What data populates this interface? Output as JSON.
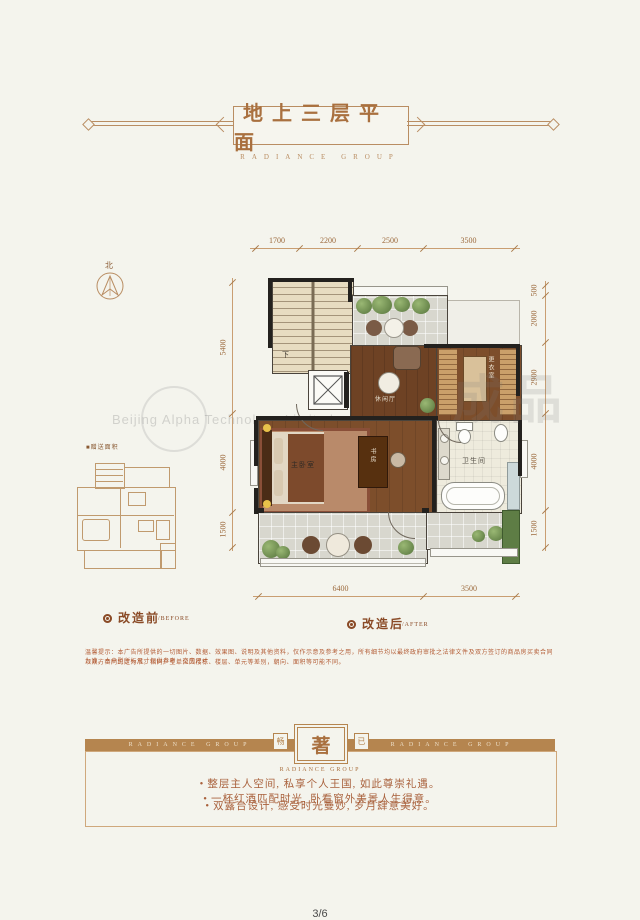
{
  "header": {
    "title": "地上三层平面",
    "subtitle": "RADIANCE GROUP"
  },
  "compass": {
    "label": "北"
  },
  "thumbnail": {
    "label": "■赠送面积"
  },
  "plan": {
    "stairs_down": "下",
    "leisure": "休闲厅",
    "dressing": "更衣室",
    "master": "主卧室",
    "study": "书房",
    "bath": "卫生间"
  },
  "dimensions": {
    "top": [
      "1700",
      "2200",
      "2500",
      "3500"
    ],
    "bottom": [
      "6400",
      "3500"
    ],
    "left": [
      "5400",
      "4000",
      "1500"
    ],
    "right": [
      "500",
      "2000",
      "2900",
      "4000",
      "1500"
    ]
  },
  "legend": {
    "before_cn": "改造前",
    "before_en": "/BEFORE",
    "after_cn": "改造后",
    "after_en": "/AFTER"
  },
  "disclaimer": {
    "line1": "温馨提示：本广告所提供的一切图片、数据、效果图、说明及其他资料，仅作示意及参考之用，所有细节均以最终政府审批之法律文件及双方签订的商品房买卖合同为准。本户型所标尺寸仅供参考，交房尺寸",
    "line2": "以双方合同约定为准。相同户型单位因楼栋、楼层、单元等差别，朝向、面积等可能不同。"
  },
  "footer": {
    "banner_text": "RADIANCE GROUP",
    "badge_main": "著",
    "badge_left": "畅",
    "badge_right": "已",
    "badge_caption": "RADIANCE GROUP",
    "bullet_glyph": "•",
    "bullets": [
      "整层主人空间, 私享个人王国, 如此尊崇礼遇。",
      "一杯红酒匹配时光, 卧看窗外美景人生得意。",
      "双露台设计, 感受时光曼妙, 岁月肆意美好。"
    ]
  },
  "watermark": {
    "company": "Beijing Alpha Technology Limited",
    "stamp": "成品"
  },
  "page_number": "3/6",
  "colors": {
    "accent": "#a9703f",
    "bar": "#b5854f",
    "dim_text": "#9c6a3d",
    "bullet_text": "#a9613c"
  }
}
